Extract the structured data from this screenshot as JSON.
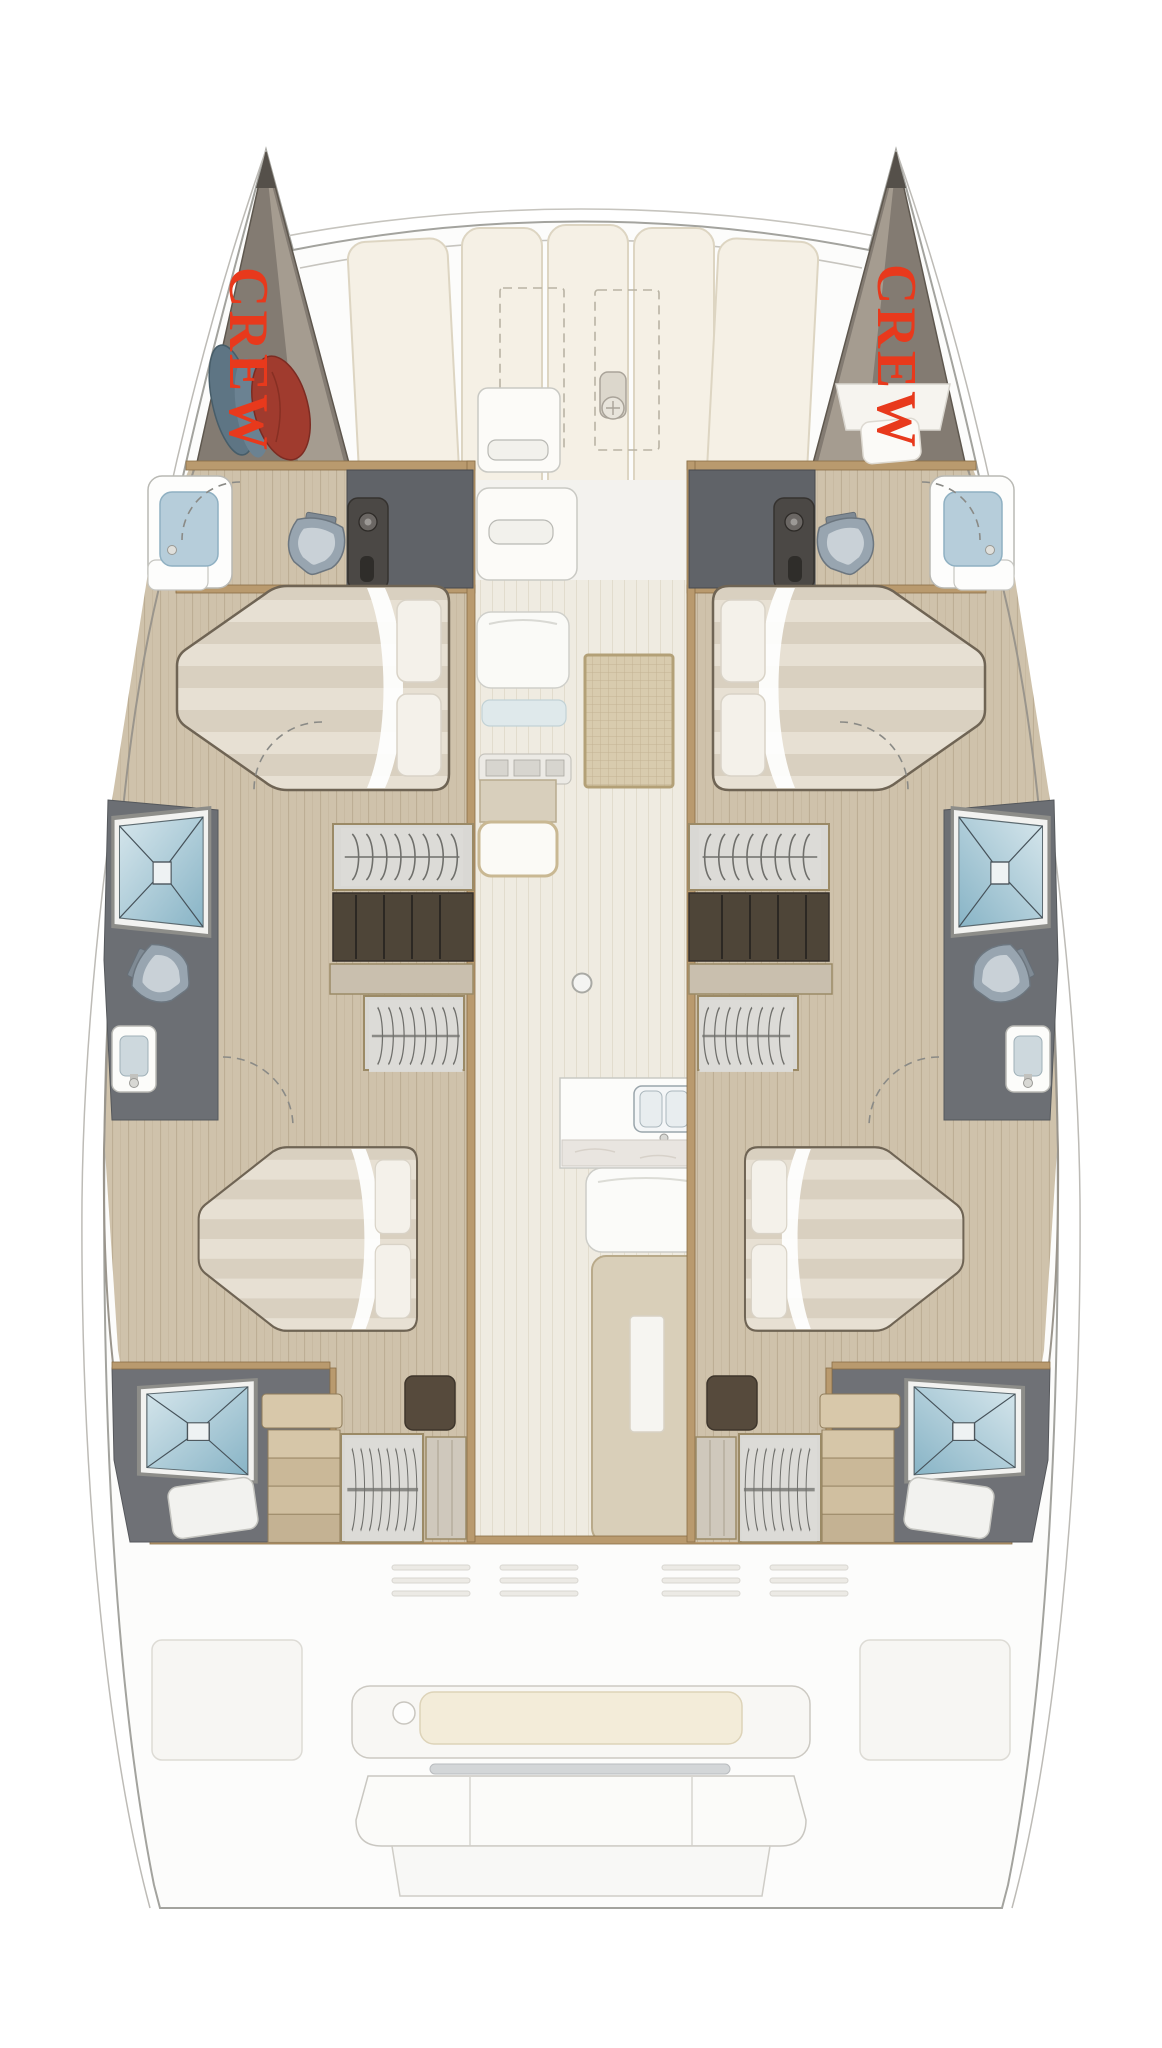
{
  "page": {
    "type": "catamaran-deck-plan",
    "background": "#ffffff"
  },
  "labels": {
    "crew_port": "CREW",
    "crew_starboard": "CREW"
  },
  "colors": {
    "crew_label": "#e8391c",
    "hull_outline": "#a3a39e",
    "lifeline": "#bdbbb6",
    "wood_floor": "#cfc2ab",
    "aisle_floor": "#efebe1",
    "bulkhead_trim": "#b99a6e",
    "dark_cabinet": "#606368",
    "charcoal_fixture": "#4b4845",
    "dark_floor": "#6c6f74",
    "shower_glass_light": "#cfe2ea",
    "shower_glass_dark": "#88b4c6",
    "toilet_body": "#98a5b0",
    "sink_basin": "#b6cdda",
    "mattress": "#e7e0d3",
    "mattress_stripe": "#d9d0c0",
    "pillow": "#f4f1ea",
    "rug": "#d8cbae",
    "table": "#d9cfb9",
    "cockpit_cushion": "#f3ecd9",
    "foredeck_cushion": "#f5f0e5",
    "ghost_line": "#ccc9c2",
    "sleeping_bag_blue": "#5e7584",
    "sleeping_bag_red": "#a03b2e",
    "crew_floor": "#837b72"
  }
}
